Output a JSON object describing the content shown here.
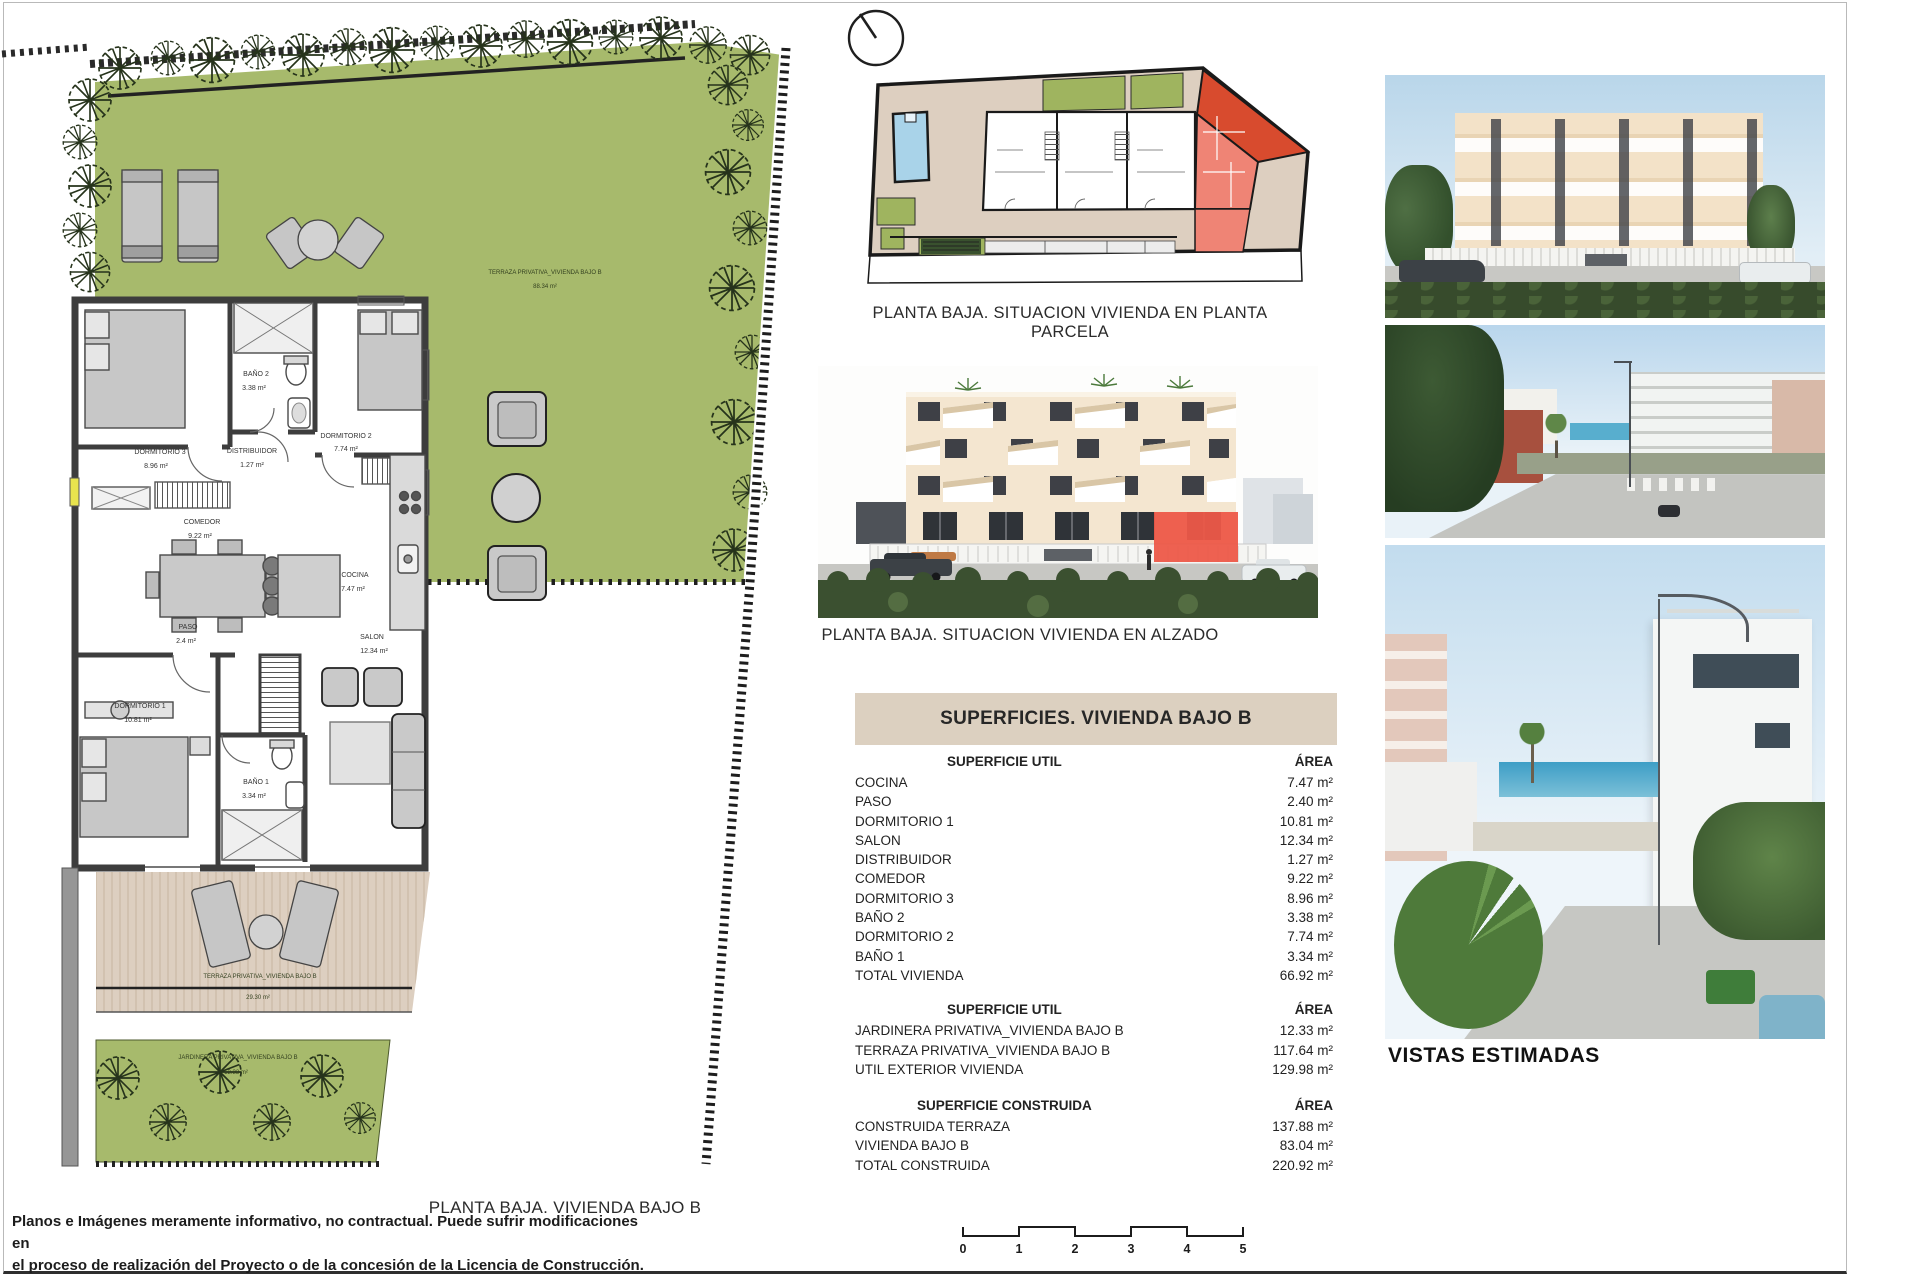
{
  "page": {
    "caption_plan": "PLANTA BAJA. VIVIENDA BAJO B",
    "disclaimer_line1": "Planos e Imágenes meramente informativo, no contractual. Puede sufrir modificaciones en",
    "disclaimer_line2": "el proceso de realización del Proyecto o de la concesión de la Licencia de Construcción."
  },
  "siteplan": {
    "caption": "PLANTA BAJA. SITUACION VIVIENDA EN PLANTA PARCELA"
  },
  "elevation": {
    "caption": "PLANTA BAJA. SITUACION VIVIENDA EN ALZADO"
  },
  "photos": {
    "caption": "VISTAS ESTIMADAS"
  },
  "floorplan": {
    "garden_label": "TERRAZA PRIVATIVA_VIVIENDA BAJO B",
    "garden_area": "88.34 m²",
    "terrace_label": "TERRAZA PRIVATIVA_VIVIENDA BAJO B",
    "terrace_area": "29.30 m²",
    "jardinera_label": "JARDINERA PRIVATIVA_VIVIENDA BAJO B",
    "jardinera_area": "12.33 m²",
    "rooms": {
      "dorm3": {
        "label": "DORMITORIO 3",
        "area": "8.96 m²"
      },
      "bano2": {
        "label": "BAÑO 2",
        "area": "3.38 m²"
      },
      "distribuidor": {
        "label": "DISTRIBUIDOR",
        "area": "1.27 m²"
      },
      "dorm2": {
        "label": "DORMITORIO 2",
        "area": "7.74 m²"
      },
      "comedor": {
        "label": "COMEDOR",
        "area": "9.22 m²"
      },
      "cocina": {
        "label": "COCINA",
        "area": "7.47 m²"
      },
      "paso": {
        "label": "PASO",
        "area": "2.4 m²"
      },
      "salon": {
        "label": "SALON",
        "area": "12.34 m²"
      },
      "dorm1": {
        "label": "DORMITORIO 1",
        "area": "10.81 m²"
      },
      "bano1": {
        "label": "BAÑO 1",
        "area": "3.34 m²"
      }
    }
  },
  "table": {
    "title": "SUPERFICIES. VIVIENDA BAJO B",
    "sections": [
      {
        "header": "SUPERFICIE UTIL",
        "area_header": "ÁREA",
        "rows": [
          {
            "label": "COCINA",
            "value": "7.47 m²"
          },
          {
            "label": "PASO",
            "value": "2.40 m²"
          },
          {
            "label": "DORMITORIO 1",
            "value": "10.81 m²"
          },
          {
            "label": "SALON",
            "value": "12.34 m²"
          },
          {
            "label": "DISTRIBUIDOR",
            "value": "1.27 m²"
          },
          {
            "label": "COMEDOR",
            "value": "9.22 m²"
          },
          {
            "label": "DORMITORIO 3",
            "value": "8.96 m²"
          },
          {
            "label": "BAÑO 2",
            "value": "3.38 m²"
          },
          {
            "label": "DORMITORIO 2",
            "value": "7.74 m²"
          },
          {
            "label": "BAÑO 1",
            "value": "3.34 m²"
          },
          {
            "label": "TOTAL VIVIENDA",
            "value": "66.92 m²"
          }
        ]
      },
      {
        "header": "SUPERFICIE UTIL",
        "area_header": "ÁREA",
        "rows": [
          {
            "label": "JARDINERA PRIVATIVA_VIVIENDA BAJO B",
            "value": "12.33 m²"
          },
          {
            "label": "TERRAZA PRIVATIVA_VIVIENDA BAJO B",
            "value": "117.64 m²"
          },
          {
            "label": "UTIL EXTERIOR VIVIENDA",
            "value": "129.98 m²"
          }
        ]
      },
      {
        "header": "SUPERFICIE CONSTRUIDA",
        "area_header": "ÁREA",
        "rows": [
          {
            "label": "CONSTRUIDA TERRAZA",
            "value": "137.88 m²"
          },
          {
            "label": "VIVIENDA BAJO B",
            "value": "83.04 m²"
          },
          {
            "label": "TOTAL CONSTRUIDA",
            "value": "220.92 m²"
          }
        ]
      }
    ]
  },
  "scalebar": {
    "ticks": [
      "0",
      "1",
      "2",
      "3",
      "4",
      "5"
    ]
  },
  "colors": {
    "garden_green": "#a7ba6c",
    "beige": "#ddcfc0",
    "parcel_red": "#d84b2e",
    "unit_light_red": "#ef8475",
    "pool_blue": "#a9d3e9",
    "highlight_red": "#ed5948"
  }
}
